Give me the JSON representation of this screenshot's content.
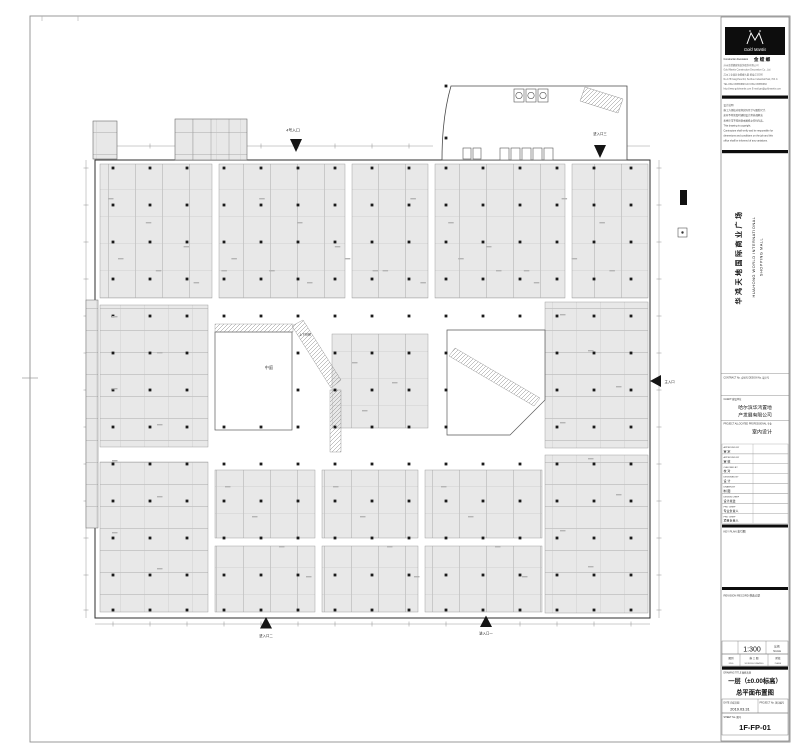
{
  "titleblock": {
    "brand": {
      "script": "Gold Mantis",
      "line_en": "Construction Decoration",
      "line_zh": "金 螳 螂",
      "company_lines": [
        "苏州金螳螂建筑装饰股份有限公司",
        "Gold Mantis Construction Decoration Co., Ltd.",
        "苏州工业园区金螳螂大厦 邮编:215000",
        "No.178 Fangzhou Rd, Suzhou Industrial Park, P.R.C.",
        "TEL:0512-65855888  FAX:0512-65855666",
        "http://www.goldmantis.com  E-mail:gm@goldmantis.com"
      ]
    },
    "notes_lines": [
      "设计说明:",
      "施工方须核对现场实际尺寸与图纸尺寸,",
      "如有不符须及时通知设计师协调解决,",
      "未经许可不得复制本图纸之任何内容。",
      "This drawing is copyright.",
      "Contractors shall verify and be responsible for",
      "dimensions and conditions on the job and this",
      "office shall be informed of any variations."
    ],
    "project": {
      "name_zh": "华鸿天地国际商业广场",
      "name_en1": "HUAHONG WORLD INTERNATIONAL",
      "name_en2": "SHOPPING MALL"
    },
    "contract_label": "CONTRACT No. 合同号   DESIGN No. 设计号",
    "client_label": "CLIENT 建设单位",
    "client_line1": "哈尔滨华鸿置地",
    "client_line2": "产发展有限公司",
    "professional_label": "PROJECT ALLOCATED PROFESSIONAL 专业",
    "professional_value": "室内设计",
    "signatures": [
      {
        "en": "APPROVED BY",
        "zh": "审  定"
      },
      {
        "en": "APPROVED BY",
        "zh": "审  核"
      },
      {
        "en": "CHECKED BY",
        "zh": "校  对"
      },
      {
        "en": "DESIGNED BY",
        "zh": "设  计"
      },
      {
        "en": "DRAWN BY",
        "zh": "制  图"
      },
      {
        "en": "DESIGN CHIEF",
        "zh": "设计总监"
      },
      {
        "en": "PRO CHIEF",
        "zh": "专业负责人"
      },
      {
        "en": "PRO CHIEF",
        "zh": "项目负责人"
      }
    ],
    "key_plan_label": "KEY PLAN 索引图",
    "revision_label": "REVISION RECORD 修改记录",
    "scale": {
      "value": "1:300",
      "label_zh": "比例",
      "label_en": "SCALE"
    },
    "meta_row": [
      {
        "l1": "图别",
        "l2": "DWG"
      },
      {
        "l1": "施 工 图",
        "l2": "WORKING DRAWING"
      },
      {
        "l1": "阶段",
        "l2": "PHASE"
      }
    ],
    "drawing_title_label": "DRAWING TITLE 图纸名称",
    "drawing_title_line1": "一层（±0.00标高）",
    "drawing_title_line2": "总平面布置图",
    "date_label": "DATE 完成日期",
    "date_value": "2019.03.31",
    "project_no_label": "PROJECT No. 项目编号",
    "sheet_no_label": "SHEET No. 图号",
    "sheet_no_value": "1F-FP-01"
  },
  "plan": {
    "entrances": [
      {
        "label": "4号入口"
      },
      {
        "label": "进入口三"
      },
      {
        "label": "主入口"
      },
      {
        "label": "进入口二"
      },
      {
        "label": "进入口一"
      }
    ],
    "labels": {
      "atrium": "中庭",
      "escalator": "上下扶梯"
    },
    "colors": {
      "shop_fill": "#e8e8e8",
      "wall": "#2e2e2e",
      "hatch": "#8a8a8a"
    }
  }
}
